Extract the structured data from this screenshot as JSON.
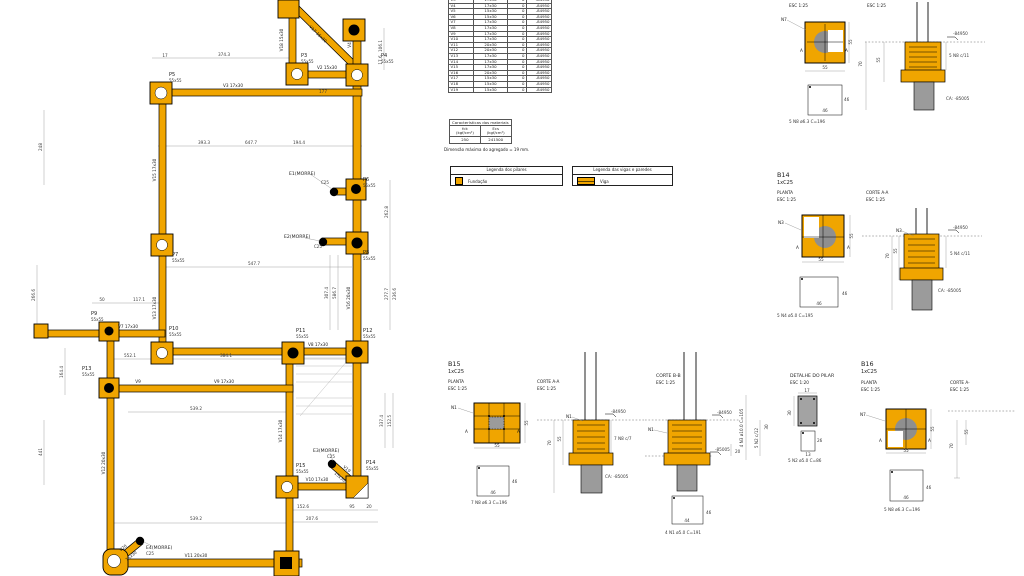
{
  "colors": {
    "beam_yellow": "#F0A500",
    "concrete_gray": "#9B9B9B",
    "circle_gray": "#8F8F8F",
    "ink": "#1c1c1c",
    "dimline_gray": "#9a9a9a"
  },
  "beam_table": {
    "rows": [
      {
        "name": "V3",
        "section": "17x30",
        "c3": "0",
        "level": "-84950"
      },
      {
        "name": "V4",
        "section": "17x30",
        "c3": "0",
        "level": "-84950"
      },
      {
        "name": "V5",
        "section": "15x30",
        "c3": "0",
        "level": "-84950"
      },
      {
        "name": "V6",
        "section": "15x30",
        "c3": "0",
        "level": "-84950"
      },
      {
        "name": "V7",
        "section": "17x30",
        "c3": "0",
        "level": "-84950"
      },
      {
        "name": "V8",
        "section": "17x30",
        "c3": "0",
        "level": "-84950"
      },
      {
        "name": "V9",
        "section": "17x30",
        "c3": "0",
        "level": "-84950"
      },
      {
        "name": "V10",
        "section": "17x30",
        "c3": "0",
        "level": "-84950"
      },
      {
        "name": "V11",
        "section": "20x30",
        "c3": "0",
        "level": "-84950"
      },
      {
        "name": "V12",
        "section": "20x30",
        "c3": "0",
        "level": "-84950"
      },
      {
        "name": "V13",
        "section": "17x30",
        "c3": "0",
        "level": "-84950"
      },
      {
        "name": "V14",
        "section": "17x30",
        "c3": "0",
        "level": "-84950"
      },
      {
        "name": "V15",
        "section": "17x30",
        "c3": "0",
        "level": "-84950"
      },
      {
        "name": "V16",
        "section": "20x30",
        "c3": "0",
        "level": "-84950"
      },
      {
        "name": "V17",
        "section": "15x30",
        "c3": "0",
        "level": "-84950"
      },
      {
        "name": "V18",
        "section": "15x30",
        "c3": "0",
        "level": "-84950"
      },
      {
        "name": "V19",
        "section": "15x30",
        "c3": "0",
        "level": "-84950"
      }
    ]
  },
  "materials": {
    "title": "Características dos materiais",
    "col1": "fck",
    "col1_unit": "(kgf/cm²)",
    "col2": "Ecs",
    "col2_unit": "(kgf/cm²)",
    "val1": "250",
    "val2": "241500",
    "note": "Dimensão máxima do agregado = 19 mm."
  },
  "legends": {
    "pilares": {
      "title": "Legenda dos pilares",
      "item": "Fundação"
    },
    "vigas": {
      "title": "Legenda das vigas e paredes",
      "item": "Viga"
    }
  },
  "plan": {
    "columns": {
      "p3": {
        "id": "P3",
        "size": "55x55"
      },
      "p4": {
        "id": "P4",
        "size": "55x55"
      },
      "p5": {
        "id": "P5",
        "size": "55x55"
      },
      "p6": {
        "id": "P6",
        "size": "55x55"
      },
      "p7": {
        "id": "P7",
        "size": "55x55"
      },
      "p8": {
        "id": "P8",
        "size": "55x55"
      },
      "p9": {
        "id": "P9",
        "size": "55x55"
      },
      "p10": {
        "id": "P10",
        "size": "55x55"
      },
      "p11": {
        "id": "P11",
        "size": "55x55"
      },
      "p12": {
        "id": "P12",
        "size": "55x55"
      },
      "p13": {
        "id": "P13",
        "size": "55x55"
      },
      "p14": {
        "id": "P14",
        "size": "55x55"
      },
      "p15": {
        "id": "P15",
        "size": "55x55"
      }
    },
    "morre": {
      "e1": {
        "id": "E1(MORRE)",
        "c": "C25"
      },
      "e2": {
        "id": "E2(MORRE)",
        "c": "C25"
      },
      "e3": {
        "id": "E3(MORRE)",
        "c": "C25"
      },
      "e4": {
        "id": "E4(MORRE)",
        "c": "C25"
      }
    },
    "beams": {
      "v2": "V2 15x30",
      "v3": "V3 17x30",
      "v4": "V4",
      "v7": "V7 17x30",
      "v8": "V8 17x30",
      "v9": "V9",
      "v9b": "V9 17x30",
      "v10": "V10 17x30",
      "v11": "V11 20x30",
      "v12": "V12 20x30",
      "v13": "V13 17x30",
      "v14": "V14 17x30",
      "v15": "V15 17x30",
      "v16": "V16 20x30",
      "v17": "V17 15x30",
      "v18": "V18 15x30",
      "v19": "V19",
      "v19s": "15x30",
      "v20": "V20",
      "v20s": "15x30"
    },
    "dims": {
      "d374": "374.3",
      "d17": "17",
      "d177": "177",
      "d393": "393.3",
      "d647": "647.7",
      "d194": "194.4",
      "d547": "547.7",
      "d117": "117.1",
      "d50": "50",
      "d384": "384.1",
      "d552": "552.1",
      "d539": "539.2",
      "d539b": "539.2",
      "d1526": "152.6",
      "d95": "95",
      "d20": "20",
      "d207": "207.6",
      "d106": "106.1",
      "d176": "17.6",
      "d262": "262.8",
      "d277": "277.7",
      "d236": "236.6",
      "d307": "307.4",
      "d586": "586.7",
      "d337": "337.4",
      "d1525": "152.5",
      "d248": "248",
      "d441": "441",
      "d164": "164.4",
      "d266": "266.6"
    }
  },
  "details": {
    "b13": {
      "planta_esc": "ESC 1:25",
      "corte_esc": "ESC 1:25",
      "n": "N7",
      "a": "A",
      "dim_w": "55",
      "dim_h": "55",
      "st1": "46",
      "st2": "46",
      "caption": "5 N8 ø6.3 C=196",
      "level": "-84950",
      "bars": "5 N8 c/11",
      "ca": "CA: -85005",
      "dim70": "70",
      "dim55": "55"
    },
    "b14": {
      "title": "B14",
      "sub": "1xC25",
      "planta": "PLANTA",
      "esc": "ESC 1:25",
      "corte": "CORTE A-A",
      "corte_esc": "ESC 1:25",
      "n": "N3",
      "a": "A",
      "dim_w": "55",
      "dim_h": "55",
      "st1": "46",
      "st2": "46",
      "caption": "5 N4 ø5.0 C=195",
      "level": "-84950",
      "bars": "5 N4 c/11",
      "ca": "CA: -85005",
      "dim70": "70",
      "dim55": "55"
    },
    "b15": {
      "title": "B15",
      "sub": "1xC25",
      "planta": "PLANTA",
      "esc": "ESC 1:25",
      "corte": "CORTE A-A",
      "corte_esc": "ESC 1:25",
      "n": "N1",
      "a": "A",
      "dim_w": "55",
      "dim_h": "55",
      "st1": "46",
      "st2": "46",
      "caption": "7 N8 ø6.3 C=196",
      "level": "-84950",
      "bars": "7 N8 c/7",
      "ca": "CA: -85005",
      "dim70": "70",
      "dim55": "55"
    },
    "corte_bb": {
      "title": "CORTE B-B",
      "esc": "ESC 1:25",
      "n": "N1",
      "level1": "-84950",
      "level2": "-85005",
      "dim20": "20",
      "dim30": "30",
      "bars_v": "4 N3 ø10.0 C=105",
      "stirr_v": "5 N2 c/12",
      "st1": "46",
      "st2": "44",
      "caption": "4 N1 ø5.0 C=191"
    },
    "detalhe": {
      "title": "DETALHE DO PILAR",
      "esc": "ESC 1:20",
      "dim17": "17",
      "dim30": "30",
      "dim26": "26",
      "dim13": "13",
      "caption": "5 N2 ø5.0 C=86"
    },
    "b16": {
      "title": "B16",
      "sub": "1xC25",
      "planta": "PLANTA",
      "esc": "ESC 1:25",
      "corte": "CORTE A-",
      "corte_esc": "ESC 1:25",
      "n": "N7",
      "a": "A",
      "dim_w": "55",
      "dim_h": "55",
      "st1": "46",
      "st2": "46",
      "caption": "5 N8 ø6.3 C=196",
      "dim70": "70",
      "dim55": "55"
    }
  }
}
